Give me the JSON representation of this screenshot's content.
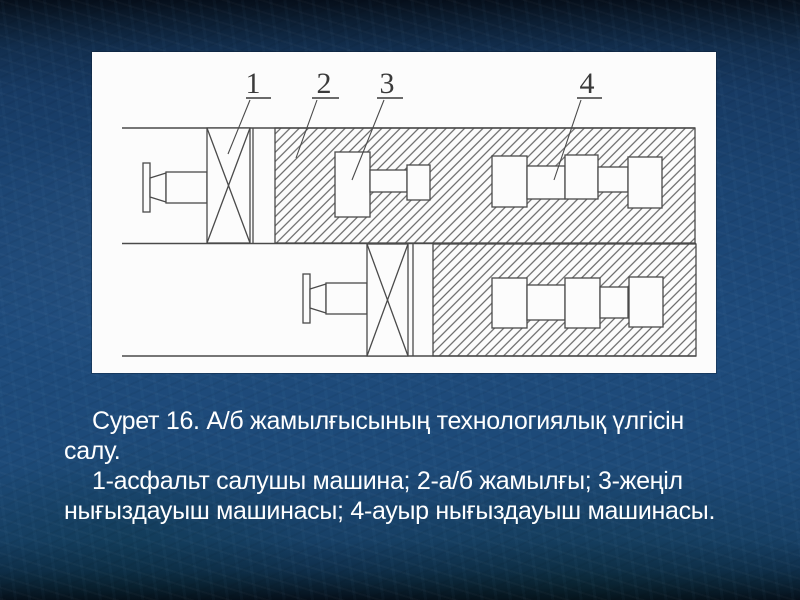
{
  "figure": {
    "callout_labels": [
      "1",
      "2",
      "3",
      "4"
    ],
    "caption_lines": [
      "Сурет 16. А/б жамылғысының технологиялық үлгісін",
      "салу.",
      "1-асфальт салушы машина; 2-а/б жамылғы; 3-жеңіл",
      "нығыздауыш машинасы; 4-ауыр нығыздауыш машинасы."
    ]
  },
  "colors": {
    "background_dark_top": "#0b1c2f",
    "background_main": "#1e4b7c",
    "panel_background": "#fcfcfc",
    "drawing_line": "#4a4a4a",
    "caption_text": "#ffffff"
  }
}
